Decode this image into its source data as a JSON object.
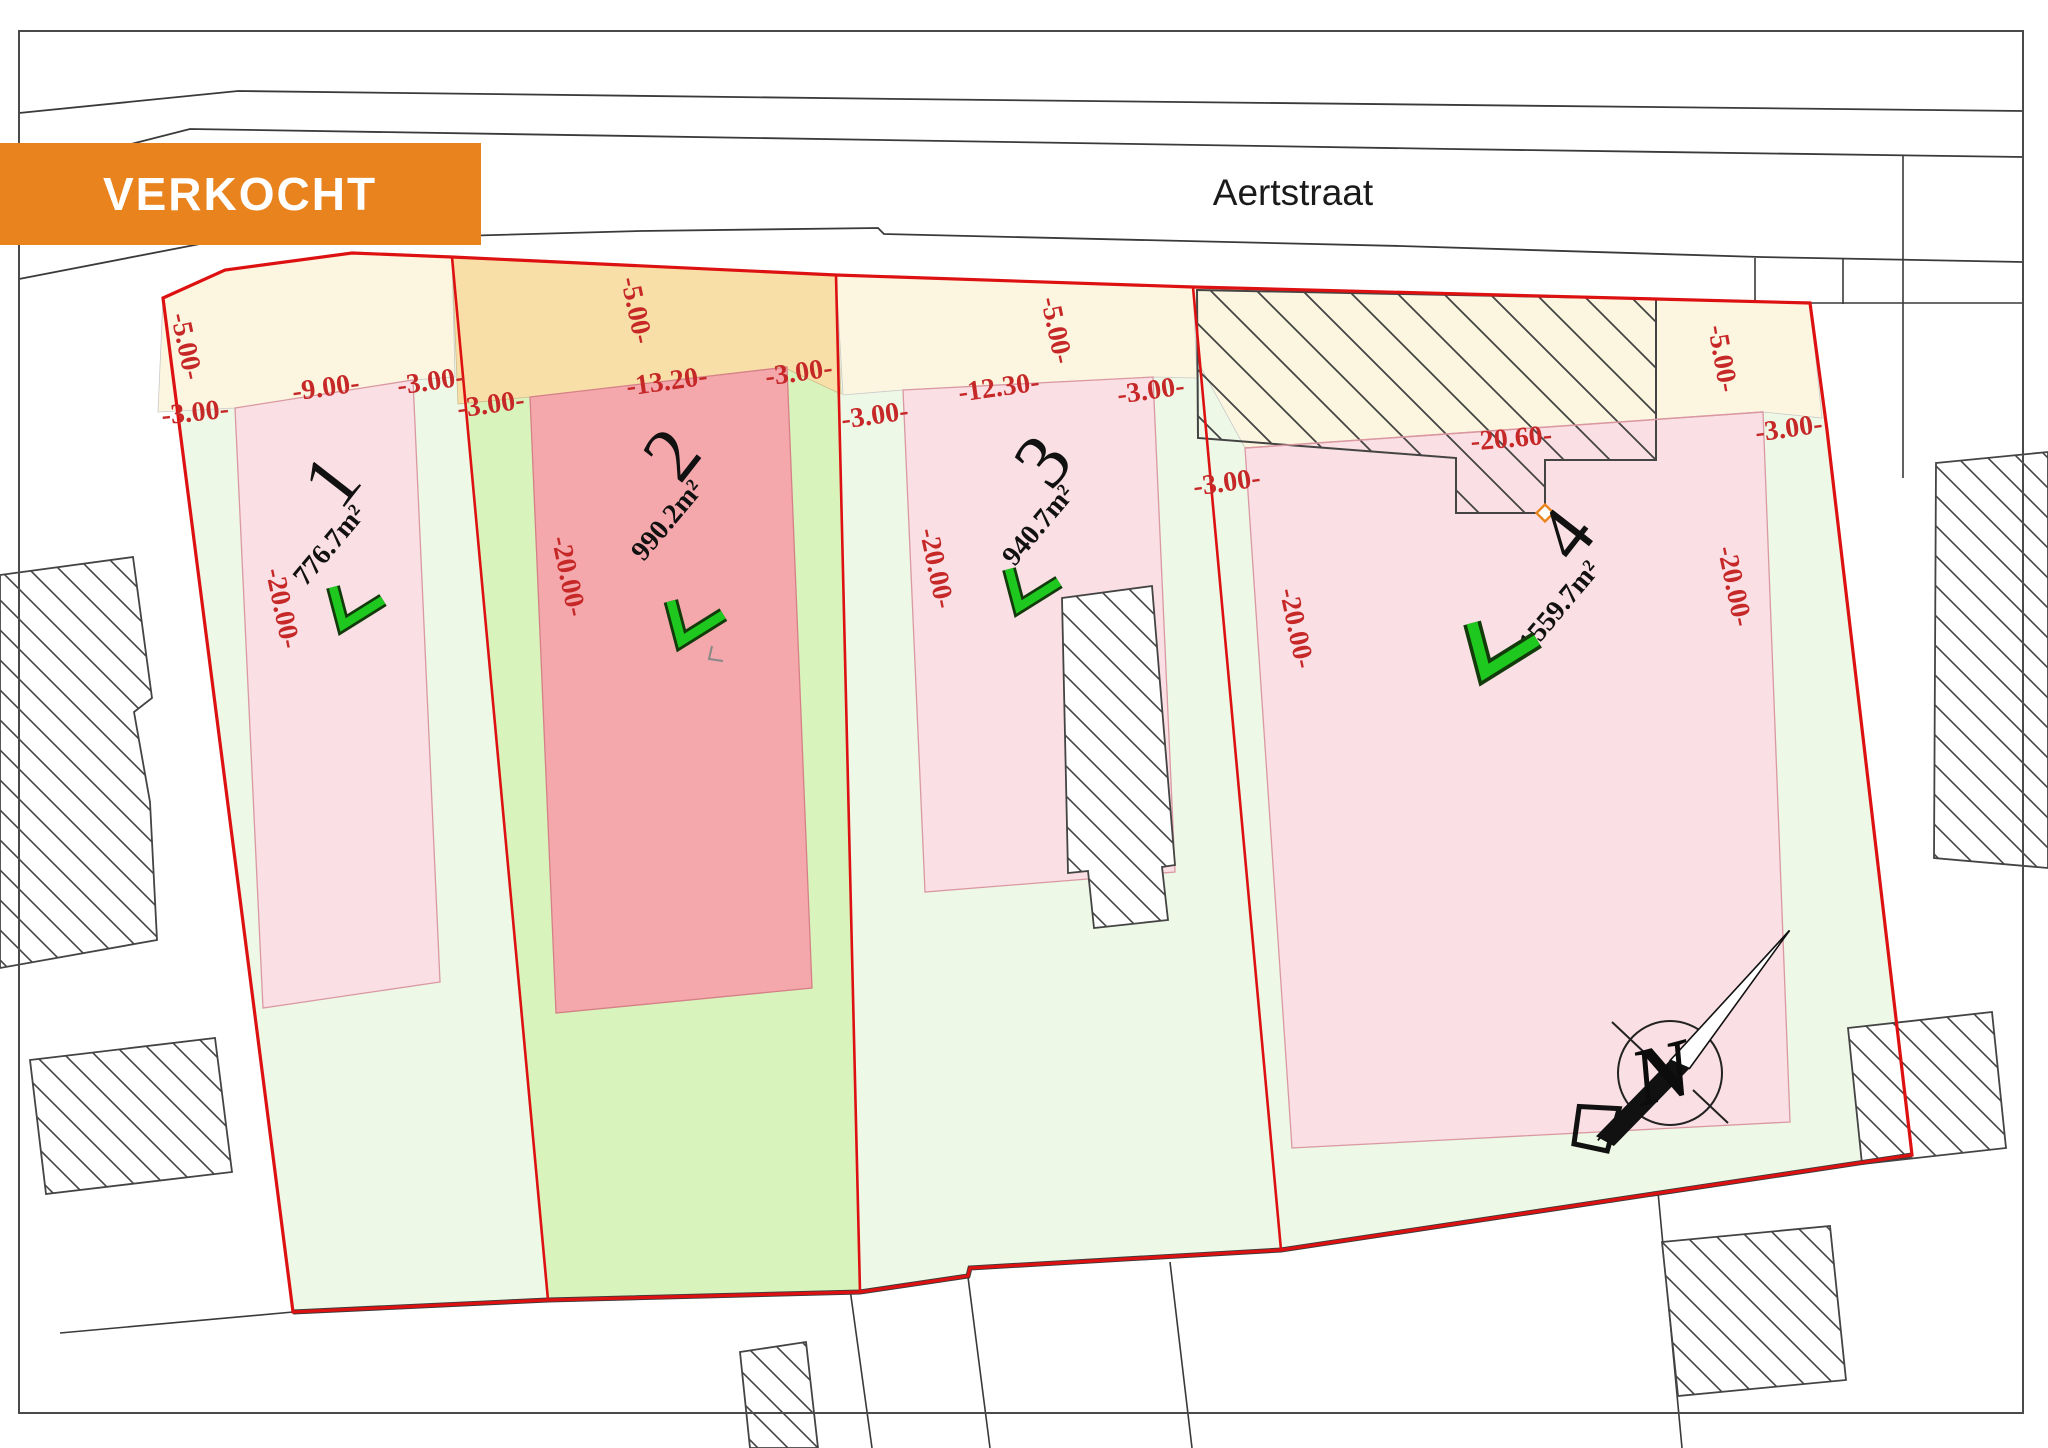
{
  "banner": {
    "label": "VERKOCHT"
  },
  "street": {
    "name": "Aertstraat"
  },
  "compass": {
    "label": "N"
  },
  "colors": {
    "banner_bg": "#E8831D",
    "banner_text": "#FFFFFF",
    "boundary_red": "#DD1111",
    "dim_red": "#C62828",
    "cream": "#FCF5DF",
    "cream_sold": "#F8DFA7",
    "pink": "#FADFE4",
    "pink_sold": "#F4A8AC",
    "green": "#EDF8E6",
    "green_sold": "#D9F3BC",
    "check_green": "#1EC81E"
  },
  "plots": [
    {
      "number": "1",
      "area": "776.7m²",
      "sold": false,
      "nx": 352,
      "ny": 497,
      "ax": 336,
      "ay": 551,
      "cx": 356,
      "cy": 607,
      "cs": 1.0
    },
    {
      "number": "2",
      "area": "990.2m²",
      "sold": true,
      "nx": 692,
      "ny": 470,
      "ax": 674,
      "ay": 526,
      "cx": 695,
      "cy": 622,
      "cs": 1.05
    },
    {
      "number": "3",
      "area": "940.7m²",
      "sold": false,
      "nx": 1063,
      "ny": 477,
      "ax": 1045,
      "ay": 531,
      "cx": 1032,
      "cy": 589,
      "cs": 1.0
    },
    {
      "number": "4",
      "area": "1559.7m²",
      "sold": false,
      "nx": 1586,
      "ny": 550,
      "ax": 1566,
      "ay": 612,
      "cx": 1502,
      "cy": 649,
      "cs": 1.3
    }
  ],
  "dim_labels": [
    {
      "t": "-5.00-",
      "x": 178,
      "y": 348,
      "r": 78
    },
    {
      "t": "-3.00-",
      "x": 196,
      "y": 421,
      "r": -6
    },
    {
      "t": "-9.00-",
      "x": 327,
      "y": 396,
      "r": -8
    },
    {
      "t": "-3.00-",
      "x": 432,
      "y": 390,
      "r": -8
    },
    {
      "t": "-3.00-",
      "x": 492,
      "y": 413,
      "r": -8
    },
    {
      "t": "-5.00-",
      "x": 628,
      "y": 312,
      "r": 78
    },
    {
      "t": "-13.20-",
      "x": 668,
      "y": 390,
      "r": -8
    },
    {
      "t": "-20.00-",
      "x": 274,
      "y": 610,
      "r": 78
    },
    {
      "t": "-20.00-",
      "x": 560,
      "y": 578,
      "r": 78
    },
    {
      "t": "-3.00-",
      "x": 800,
      "y": 381,
      "r": -8
    },
    {
      "t": "-3.00-",
      "x": 876,
      "y": 424,
      "r": -8
    },
    {
      "t": "-5.00-",
      "x": 1048,
      "y": 332,
      "r": 78
    },
    {
      "t": "-12.30-",
      "x": 1000,
      "y": 396,
      "r": -8
    },
    {
      "t": "-20.00-",
      "x": 928,
      "y": 570,
      "r": 78
    },
    {
      "t": "-3.00-",
      "x": 1152,
      "y": 399,
      "r": -8
    },
    {
      "t": "-3.00-",
      "x": 1228,
      "y": 491,
      "r": -8
    },
    {
      "t": "-20.60-",
      "x": 1512,
      "y": 447,
      "r": -5
    },
    {
      "t": "-5.00-",
      "x": 1714,
      "y": 360,
      "r": 80
    },
    {
      "t": "-3.00-",
      "x": 1790,
      "y": 437,
      "r": -8
    },
    {
      "t": "-20.00-",
      "x": 1288,
      "y": 630,
      "r": 78
    },
    {
      "t": "-20.00-",
      "x": 1726,
      "y": 588,
      "r": 78
    }
  ]
}
